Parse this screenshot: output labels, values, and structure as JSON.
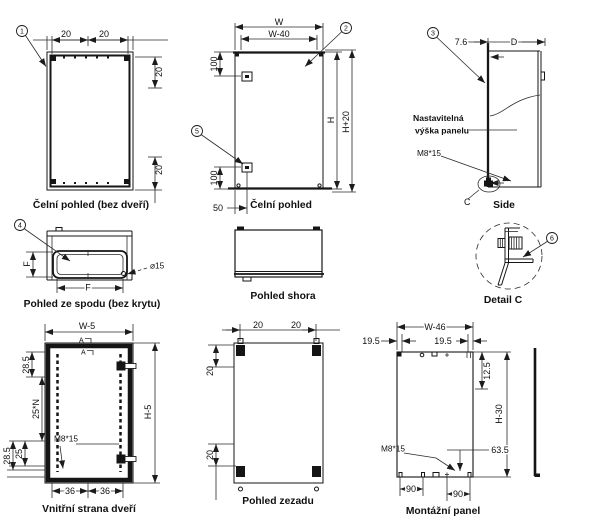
{
  "line_color": "#151515",
  "views": {
    "front_no_door": {
      "caption": "Čelní pohled (bez dveří)",
      "callout": "1",
      "dim_top_left": "20",
      "dim_top_right": "20",
      "dim_right_top": "20",
      "dim_right_bottom": "20"
    },
    "front": {
      "caption": "Čelní pohled",
      "callout_door": "2",
      "callout_hinge": "5",
      "dim_width": "W",
      "dim_width_inner": "W-40",
      "dim_left_top": "100",
      "dim_left_bottom": "100",
      "dim_bottom": "50",
      "dim_height": "H",
      "dim_height_total": "H+20"
    },
    "side": {
      "caption": "Side",
      "callout": "3",
      "dim_offset": "7.6",
      "dim_depth": "D",
      "label_panel_line1": "Nastavitelná",
      "label_panel_line2": "výška panelu",
      "label_bolt": "M8*15",
      "label_detail": "C"
    },
    "bottom_no_cover": {
      "caption": "Pohled ze spodu (bez krytu)",
      "callout": "4",
      "dim_f_vertical": "F",
      "dim_f_horizontal": "F",
      "dim_hole": "⌀15"
    },
    "top": {
      "caption": "Pohled shora"
    },
    "detail_c": {
      "caption": "Detail C",
      "callout": "6"
    },
    "door_inner": {
      "caption": "Vnitřní strana dveří",
      "dim_width": "W-5",
      "dim_height": "H-5",
      "dim_left_1": "28.5",
      "dim_left_2": "25*N",
      "dim_left_3": "25",
      "dim_left_4": "28.5",
      "dim_bottom_1": "36",
      "dim_bottom_2": "36",
      "label_bolt": "M8*15",
      "section_mark": "A"
    },
    "rear": {
      "caption": "Pohled zezadu",
      "dim_top_1": "20",
      "dim_top_2": "20",
      "dim_left_top": "20",
      "dim_left_bottom": "20"
    },
    "mounting_panel": {
      "caption": "Montážní panel",
      "dim_width": "W-46",
      "dim_top_left": "19.5",
      "dim_top_right": "19.5",
      "dim_right_top": "12.5",
      "dim_height": "H-30",
      "dim_hole": "63.5",
      "dim_bottom_1": "90",
      "dim_bottom_2": "90",
      "label_bolt": "M8*15"
    }
  }
}
